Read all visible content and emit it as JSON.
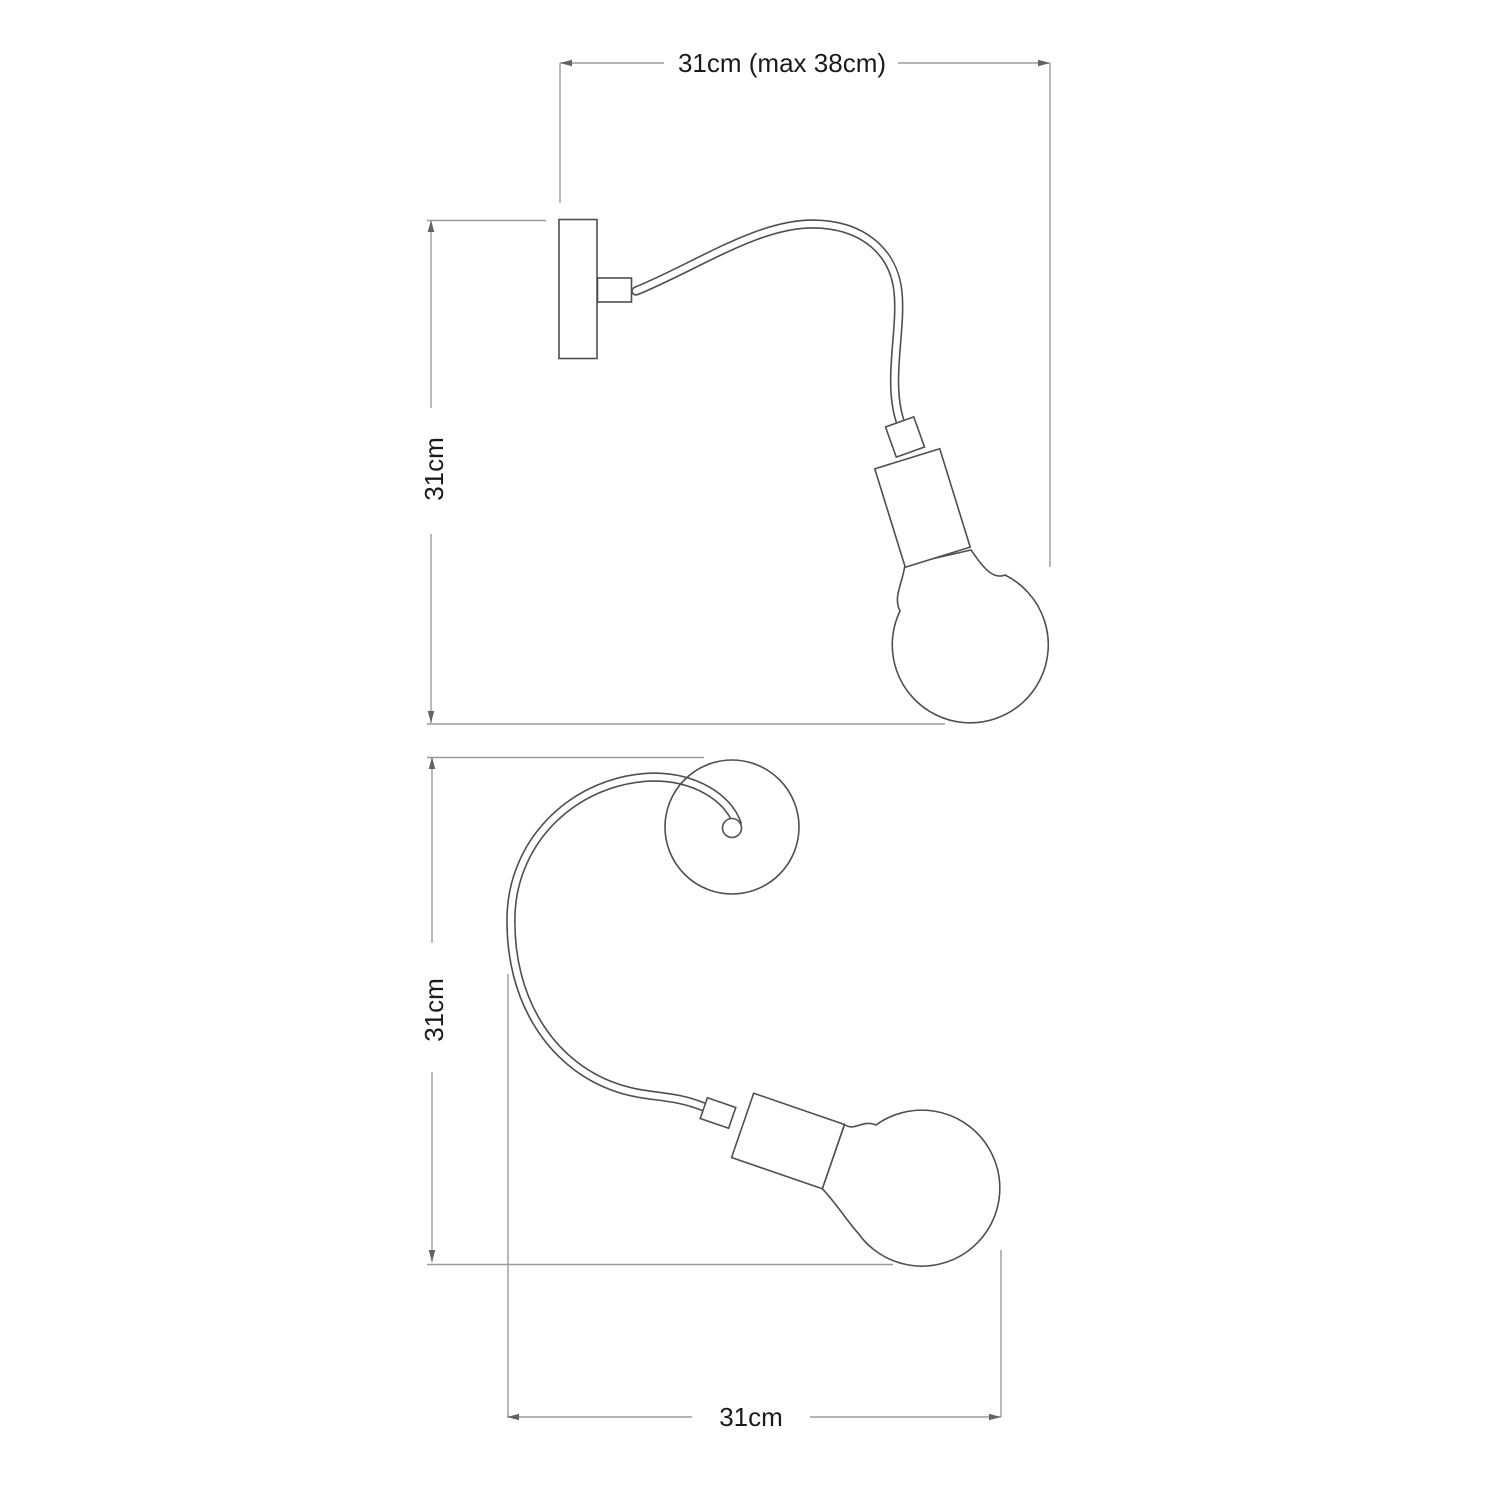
{
  "page": {
    "background": "#ffffff",
    "description": "Technical dimension drawing of a flexible gooseneck wall light with exposed bulb, shown in side view (top) and plan view (bottom)"
  },
  "colors": {
    "outline": "#4f4f4f",
    "dimension_line": "#9b9b9b",
    "label_text": "#1b1b1b"
  },
  "views": {
    "side": {
      "name": "side view",
      "width_label": "31cm (max 38cm)",
      "height_label": "31cm"
    },
    "top": {
      "name": "top view",
      "height_label": "31cm",
      "width_label": "31cm"
    }
  }
}
